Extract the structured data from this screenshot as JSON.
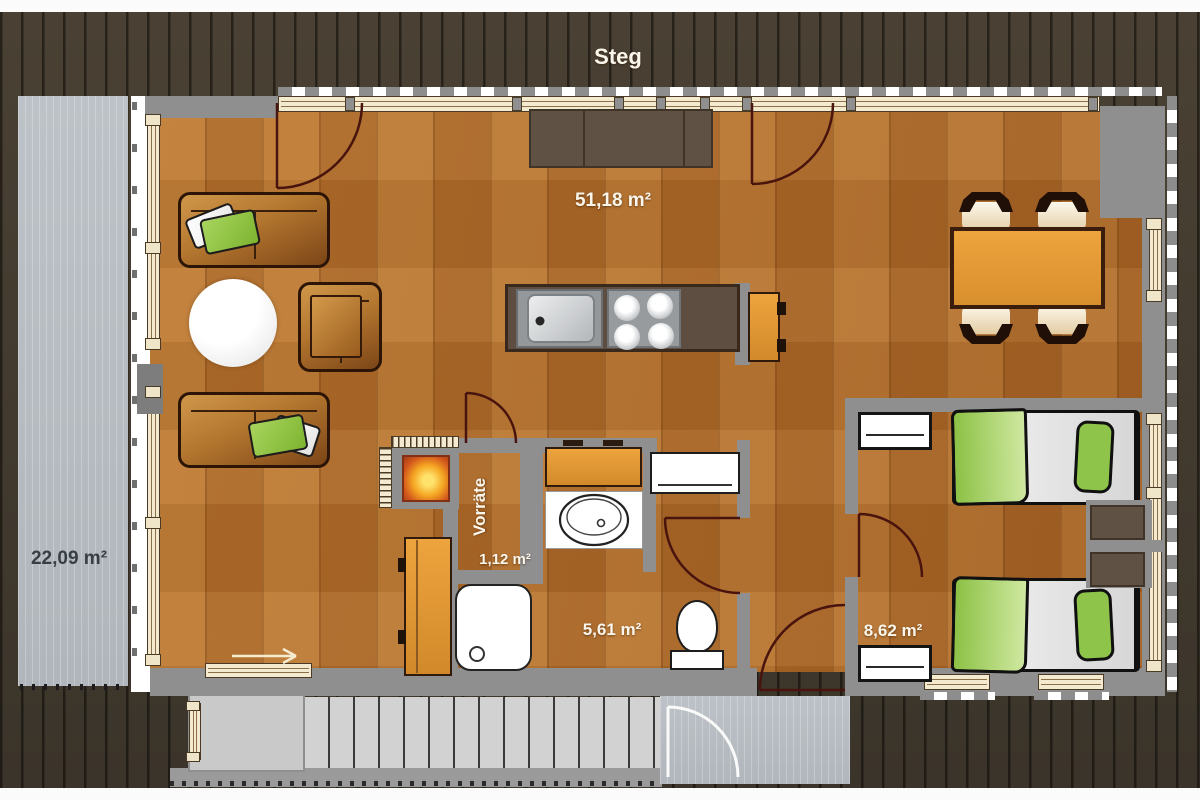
{
  "plan": {
    "deck_label": "Steg",
    "rooms": [
      {
        "name": "terrace",
        "area": "22,09 m²"
      },
      {
        "name": "living-dining",
        "area": "51,18 m²"
      },
      {
        "name": "pantry",
        "label": "Vorräte",
        "area": "1,12 m²"
      },
      {
        "name": "bathroom",
        "area": "5,61 m²"
      },
      {
        "name": "bedroom",
        "area": "8,62 m²"
      }
    ],
    "colors": {
      "decking": "#433a2e",
      "terrace_gray": "#b9bfc4",
      "wood_floor": "#b3702d",
      "wall": "#8f8f8f",
      "window_frame_cream": "#f3ead0",
      "accent_orange": "#e5a03c",
      "bed_green": "#8ec44a",
      "counter_brown": "#5e4e42",
      "door_swing": "#4a140e",
      "label_white": "#faf6ec",
      "terrace_label_dark": "#383f44"
    }
  }
}
